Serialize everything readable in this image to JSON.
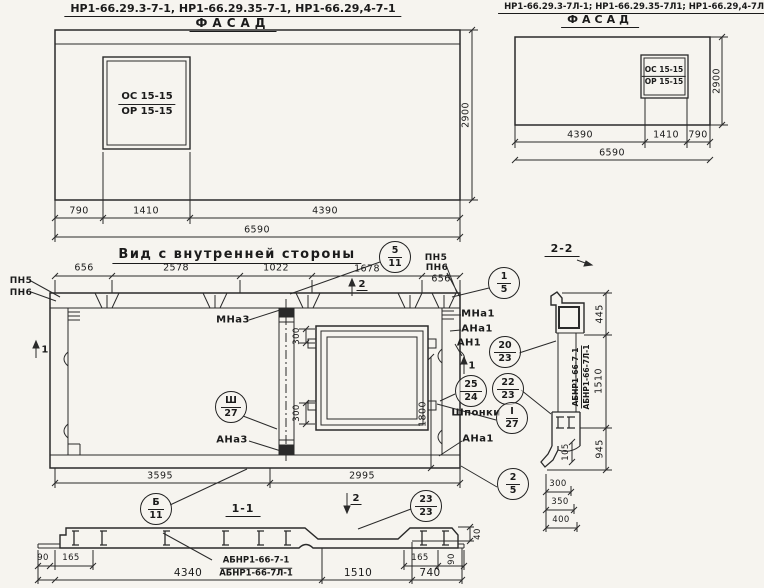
{
  "drawing": {
    "facade_left": {
      "title": "НР1-66.29.3-7-1, НР1-66.29.35-7-1, НР1-66.29,4-7-1",
      "view_label": "Фасад",
      "opening_mark": {
        "top": "ОС 15-15",
        "bottom": "ОР 15-15"
      },
      "dims": {
        "d790": "790",
        "d1410": "1410",
        "d4390": "4390",
        "total": "6590",
        "height": "2900"
      }
    },
    "facade_right": {
      "title": "НР1-66.29.3-7Л-1; НР1-66.29.35-7Л1; НР1-66.29,4-7Л1",
      "view_label": "Фасад",
      "opening_mark": {
        "top": "ОС 15-15",
        "bottom": "ОР 15-15"
      },
      "dims": {
        "d4390": "4390",
        "d1410": "1410",
        "d790": "790",
        "total": "6590",
        "height": "2900"
      }
    },
    "inner_view": {
      "title": "Вид с внутренней стороны",
      "dims_top": [
        "656",
        "2578",
        "1022",
        "1678",
        "656"
      ],
      "dims_bottom": [
        "3595",
        "2995"
      ],
      "dims_window": {
        "t300": "300",
        "b300": "300",
        "h1800": "1800"
      },
      "labels": {
        "pn5": "ПН5",
        "pn6": "ПН6",
        "mna3": "МНа3",
        "ana3": "АНа3",
        "mna1": "МНа1",
        "ana1": "АНа1",
        "an1": "АН1",
        "ana1_b": "АНа1",
        "shponki": "Шпонки",
        "sec1": "1",
        "sec2": "2"
      },
      "callouts": {
        "k5_11": {
          "top": "5",
          "bottom": "11"
        },
        "k1_5": {
          "top": "1",
          "bottom": "5"
        },
        "k20_23": {
          "top": "20",
          "bottom": "23"
        },
        "k25_24": {
          "top": "25",
          "bottom": "24"
        },
        "k22_23": {
          "top": "22",
          "bottom": "23"
        },
        "kI_27": {
          "top": "I",
          "bottom": "27"
        },
        "kIII_27": {
          "top": "Ш",
          "bottom": "27"
        },
        "kB_11": {
          "top": "Б",
          "bottom": "11"
        },
        "k23_23": {
          "top": "23",
          "bottom": "23"
        },
        "k2_5": {
          "top": "2",
          "bottom": "5"
        }
      }
    },
    "section_1_1": {
      "title": "1-1",
      "beam_mark": {
        "top": "АБНР1-66-7-1",
        "bottom": "АБНР1-66-7Л-1"
      },
      "dims": {
        "left90": "90",
        "left165": "165",
        "d4340": "4340",
        "d1510": "1510",
        "d740": "740",
        "right165": "165",
        "right90": "90",
        "d40": "40"
      }
    },
    "section_2_2": {
      "title": "2-2",
      "beam_mark": {
        "top": "АБНР1-66-7-1",
        "bottom": "АБНР1-66-7Л-1"
      },
      "dims": {
        "d445": "445",
        "d1510": "1510",
        "d945": "945",
        "d105": "105",
        "d300": "300",
        "d350": "350",
        "d400": "400"
      }
    }
  }
}
